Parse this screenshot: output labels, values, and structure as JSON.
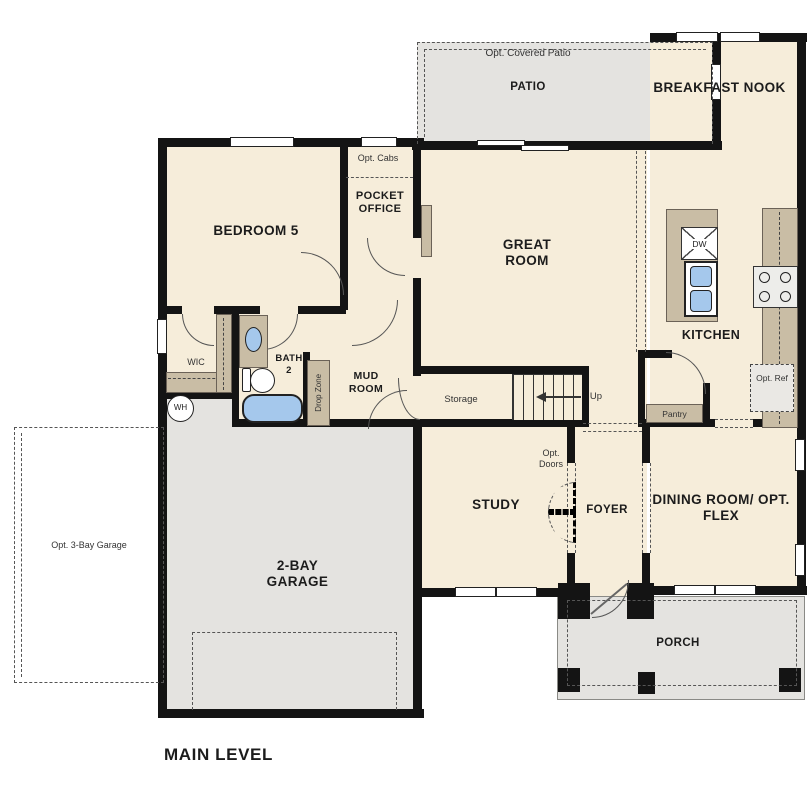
{
  "title": "MAIN LEVEL",
  "rooms": {
    "opt_covered_patio": "Opt. Covered Patio",
    "patio": "PATIO",
    "breakfast_nook": "BREAKFAST NOOK",
    "opt_cabs": "Opt. Cabs",
    "pocket_office": "POCKET OFFICE",
    "bedroom_5": "BEDROOM 5",
    "great_room": "GREAT ROOM",
    "kitchen": "KITCHEN",
    "wic": "WIC",
    "bath_2": "BATH 2",
    "mud_room": "MUD ROOM",
    "drop_zone": "Drop Zone",
    "storage": "Storage",
    "stairs_up": "Up",
    "water_heater": "WH",
    "dishwasher": "DW",
    "opt_ref": "Opt. Ref",
    "pantry": "Pantry",
    "opt_doors": "Opt. Doors",
    "study": "STUDY",
    "foyer": "FOYER",
    "dining_room": "DINING ROOM/ OPT. FLEX",
    "opt_3bay_garage": "Opt. 3-Bay Garage",
    "garage_2bay": "2-BAY GARAGE",
    "porch": "PORCH"
  },
  "colors": {
    "room_fill": "#f6edda",
    "outdoor_fill": "#e4e3e0",
    "cabinet_fill": "#c9bda5",
    "fixture_blue": "#a5c8ec",
    "wall": "#141414"
  }
}
